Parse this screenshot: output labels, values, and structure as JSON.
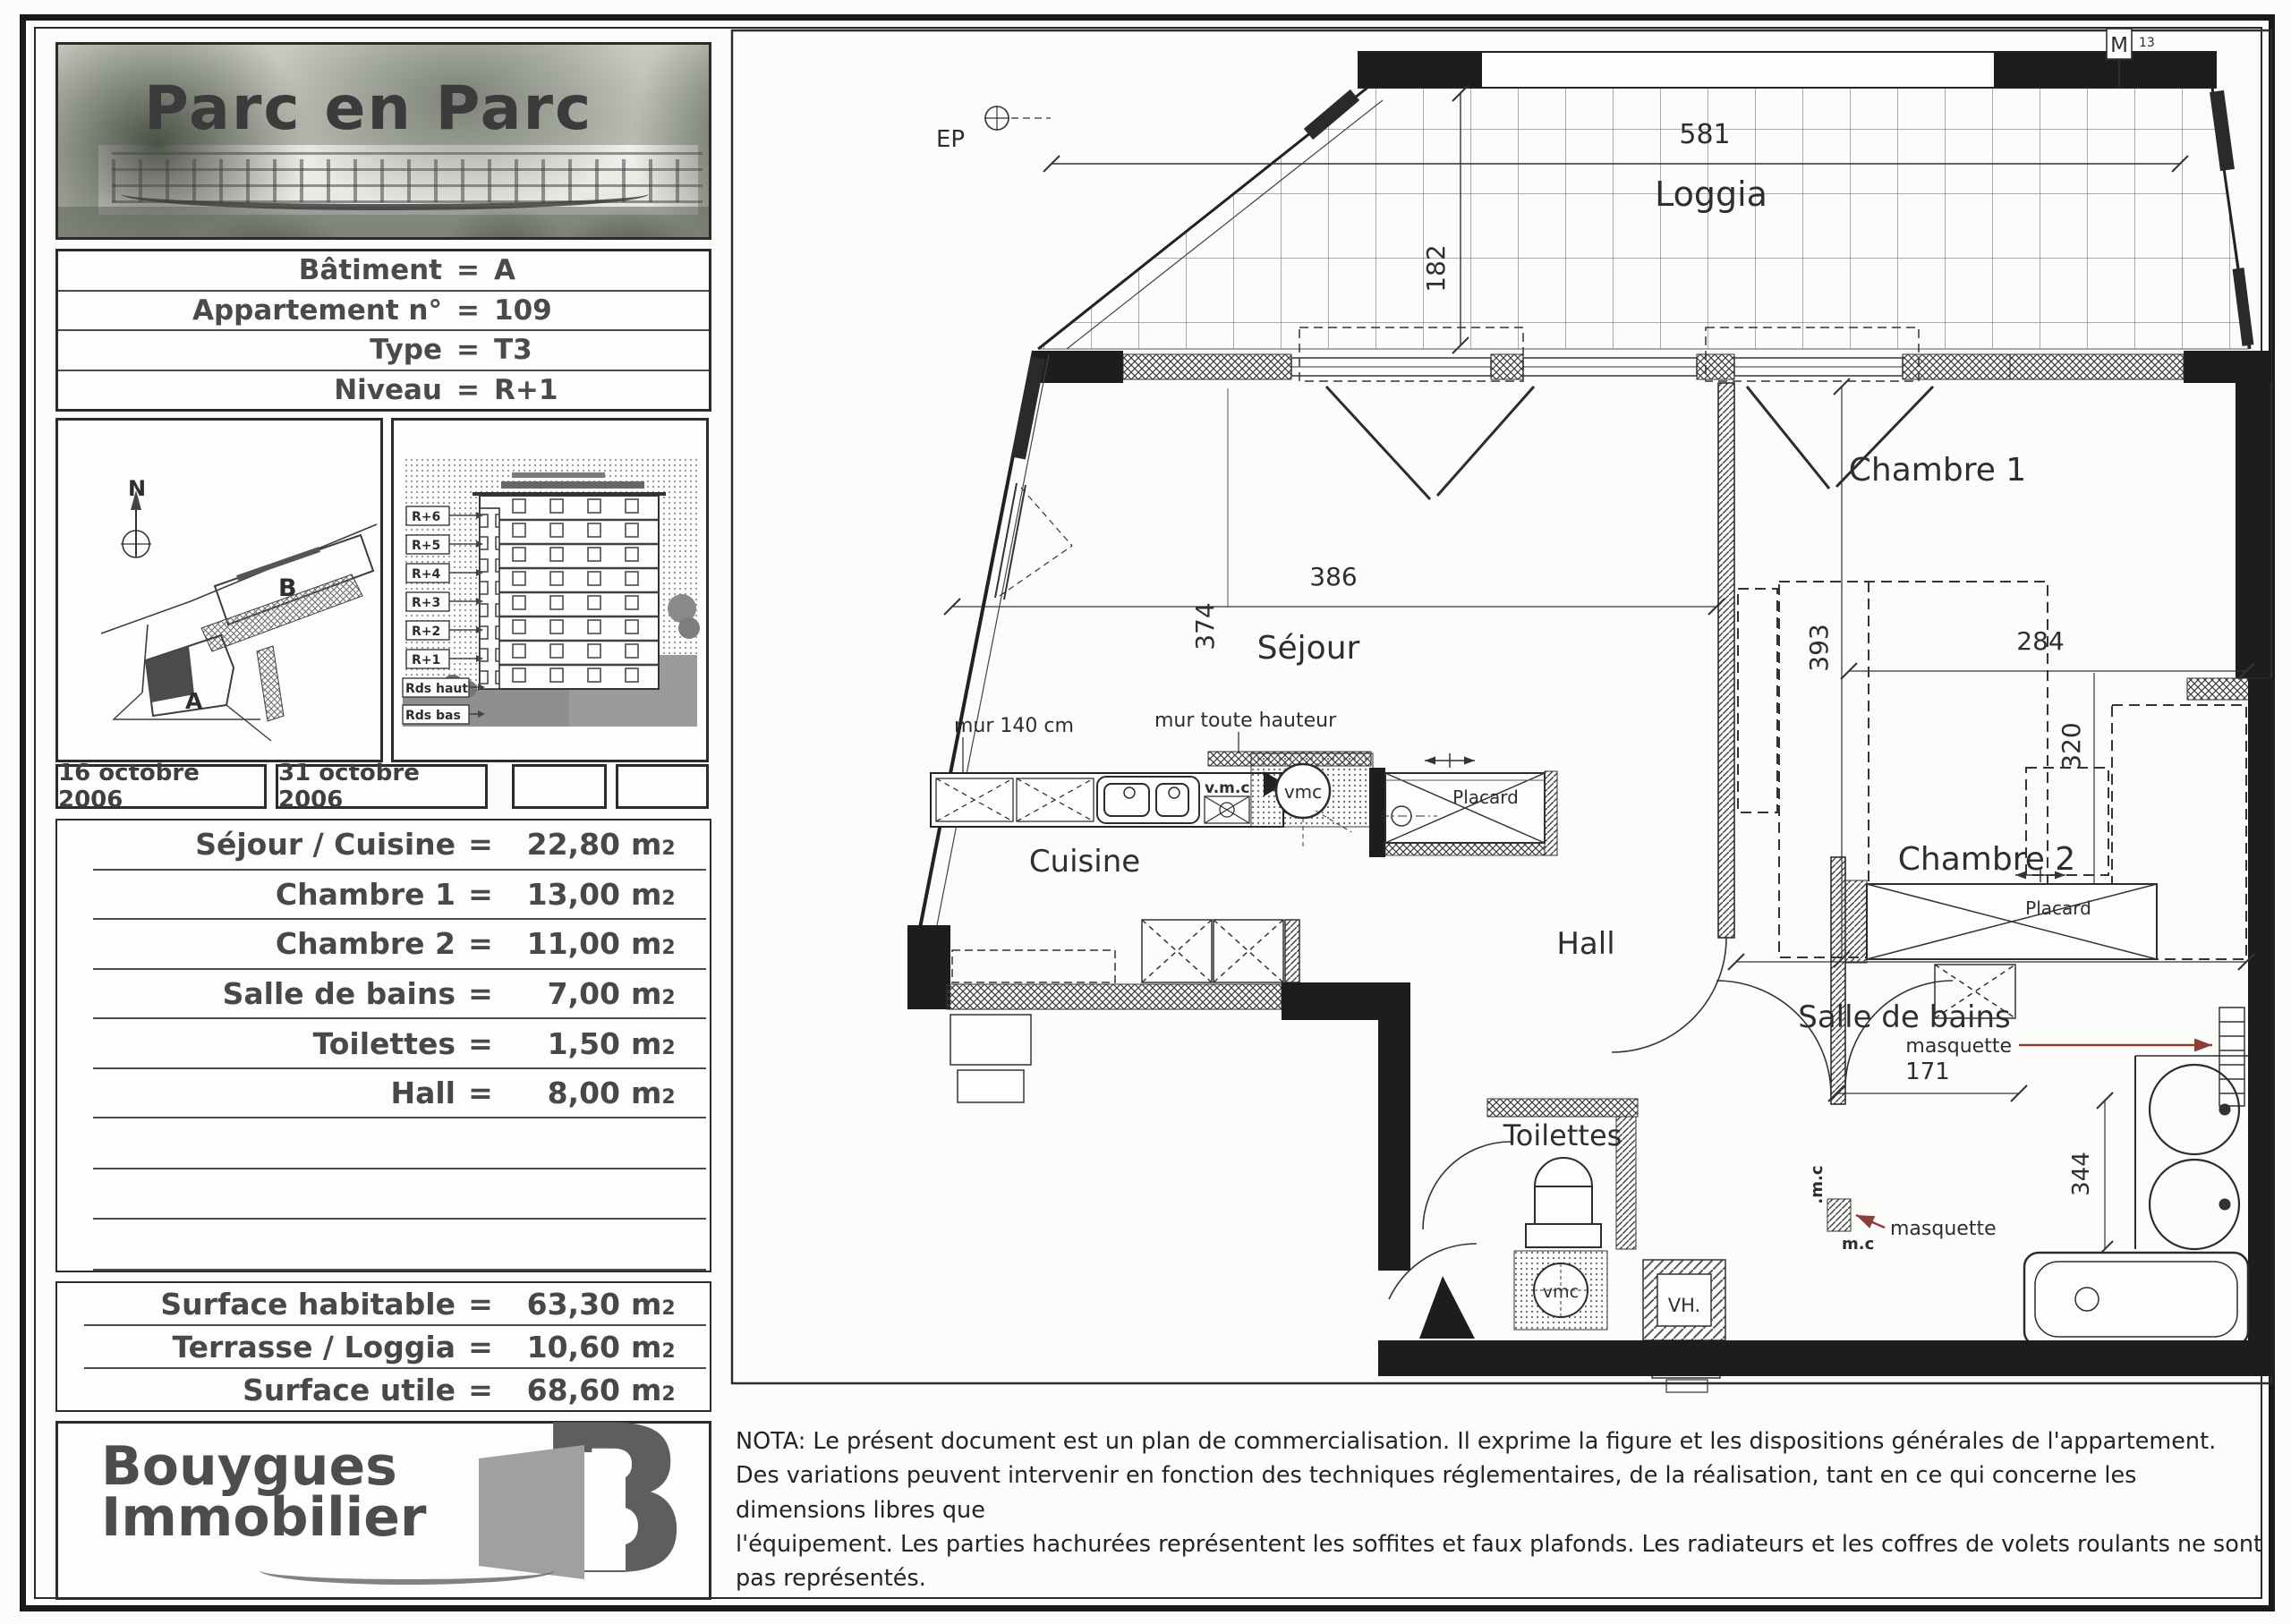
{
  "page": {
    "title": "Parc en Parc",
    "eq": "=",
    "unit": "m",
    "unit_sub": "2"
  },
  "info": {
    "rows": [
      {
        "label": "Bâtiment",
        "value": "A"
      },
      {
        "label": "Appartement n°",
        "value": "109"
      },
      {
        "label": "Type",
        "value": "T3"
      },
      {
        "label": "Niveau",
        "value": "R+1"
      }
    ]
  },
  "site_plan": {
    "north": "N",
    "building_a": "A",
    "building_b": "B"
  },
  "section": {
    "levels": [
      "R+6",
      "R+5",
      "R+4",
      "R+3",
      "R+2",
      "R+1",
      "Rds haut",
      "Rds bas"
    ]
  },
  "dates": {
    "from": "16 octobre 2006",
    "to": "31 octobre 2006"
  },
  "rooms": {
    "rows": [
      {
        "label": "Séjour / Cuisine",
        "value": "22,80"
      },
      {
        "label": "Chambre 1",
        "value": "13,00"
      },
      {
        "label": "Chambre 2",
        "value": "11,00"
      },
      {
        "label": "Salle de bains",
        "value": "7,00"
      },
      {
        "label": "Toilettes",
        "value": "1,50"
      },
      {
        "label": "Hall",
        "value": "8,00"
      }
    ]
  },
  "surfaces": {
    "rows": [
      {
        "label": "Surface habitable",
        "value": "63,30"
      },
      {
        "label": "Terrasse / Loggia",
        "value": "10,60"
      },
      {
        "label": "Surface utile",
        "value": "68,60"
      }
    ]
  },
  "logo": {
    "line1": "Bouygues",
    "line2": "Immobilier",
    "mark": "B"
  },
  "nota": {
    "line1": "NOTA: Le présent document est un plan de commercialisation. Il exprime la figure et les dispositions générales de l'appartement.",
    "line2": "Des variations peuvent intervenir en fonction des techniques réglementaires, de la réalisation, tant en ce qui concerne les dimensions libres que",
    "line3": "l'équipement. Les parties hachurées représentent les soffites et faux plafonds. Les radiateurs et les coffres de volets roulants ne sont pas représentés."
  },
  "plan": {
    "rooms": {
      "loggia": "Loggia",
      "sejour": "Séjour",
      "cuisine": "Cuisine",
      "chambre1": "Chambre 1",
      "chambre2": "Chambre 2",
      "hall": "Hall",
      "sdb": "Salle de bains",
      "toilettes": "Toilettes"
    },
    "dims": {
      "d581": "581",
      "d182": "182",
      "d386": "386",
      "d374": "374",
      "d393": "393",
      "d309": "309",
      "d284": "284",
      "d320": "320",
      "d171": "171",
      "d344": "344"
    },
    "labels": {
      "ep": "EP",
      "m_marker": "M",
      "m_sub": "13",
      "mur140": "mur 140 cm",
      "murth": "mur toute hauteur",
      "vmc_text": "v.m.c",
      "vmc1": "vmc",
      "vmc2": "vmc",
      "placard1": "Placard",
      "placard2": "Placard",
      "masquette1": "masquette",
      "masquette2": "masquette",
      "mc1": ".m.c",
      "mc2": "m.c",
      "vh": "VH."
    },
    "colors": {
      "ink": "#2e2e2e",
      "wall": "#1d1d1d",
      "accent_arrow": "#8a4038"
    }
  }
}
